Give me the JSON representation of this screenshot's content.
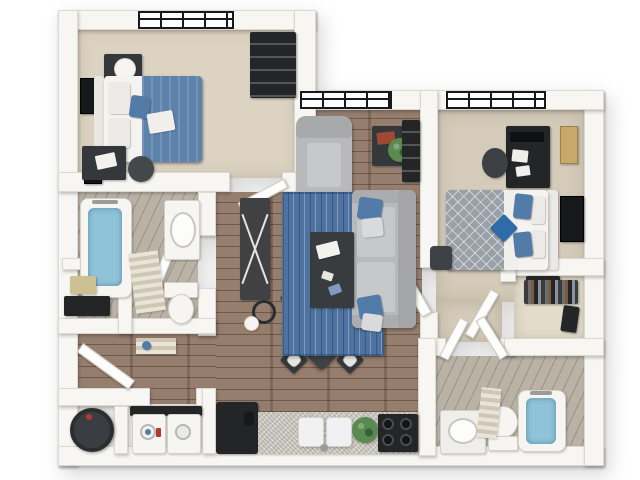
{
  "scene": {
    "title": "3D top-down floor plan of a two-bedroom, two-bathroom apartment",
    "view": "overhead 3D render, white outer background",
    "text_content": "none (image contains no visible text)"
  },
  "palette": {
    "wall": "#f7f6f2",
    "wedge": "#dcd9d2",
    "carpet": "#dcd3c2",
    "carpet2": "#d4cbba",
    "closetfloor": "#e3dccb",
    "wood": "#8b7260",
    "bathfloor": "#b5ac9f",
    "utilityfloor": "#e8e6e1",
    "rug": "#4e73a0",
    "sofa": "#b7b9bb",
    "cushion": "#c6c8ca",
    "dark": "#35383b",
    "darker": "#232527",
    "whiteobj": "#f6f5f2",
    "water": "#8fc3d8",
    "blue": "#527ba8",
    "denim": "#5d82ab",
    "graybed": "#9aa0a8",
    "granite": "#cbc8c0",
    "plantc": "#5a8a52",
    "tanc": "#cdc093",
    "art": "#17181a",
    "red": "#9c4a33",
    "doorleaf": "#fdfdfb"
  },
  "rooms": [
    {
      "name": "bedroom-1",
      "position": "top-left",
      "flooring": "carpet",
      "contents": [
        "window",
        "bed with white linens and denim-blue blanket",
        "blue accent pillow",
        "nightstand with lamp",
        "two wall art frames",
        "desk with laptop",
        "desk chair",
        "closet with dark shelving"
      ]
    },
    {
      "name": "bathroom-1",
      "position": "middle-left",
      "flooring": "gray wood plank",
      "contents": [
        "bathtub with water",
        "striped bath mat",
        "vanity with oval sink",
        "toilet",
        "linen niche with basket"
      ]
    },
    {
      "name": "entry",
      "position": "lower-left",
      "flooring": "wood plank",
      "contents": [
        "open entry door",
        "striped doormat",
        "blue watering can"
      ]
    },
    {
      "name": "utility-laundry",
      "position": "bottom-left",
      "flooring": "light",
      "contents": [
        "water heater",
        "washer",
        "dryer"
      ]
    },
    {
      "name": "kitchen",
      "position": "bottom-center",
      "flooring": "wood plank",
      "contents": [
        "refrigerator",
        "granite counter",
        "double-basin sink",
        "potted plant",
        "four-burner cooktop"
      ]
    },
    {
      "name": "dining-area",
      "position": "center-bottom",
      "flooring": "wood plank",
      "contents": [
        "square table rotated 45 degrees",
        "four chairs",
        "table decor"
      ]
    },
    {
      "name": "living-room",
      "position": "center",
      "flooring": "wood plank",
      "contents": [
        "window",
        "gray armchair",
        "side table with plant and red books",
        "ladder bookshelf",
        "blue area rug",
        "dark coffee table with books",
        "gray sofa with blue pillows",
        "tv console with x-legs",
        "floor lamp"
      ]
    },
    {
      "name": "bedroom-2",
      "position": "top-right",
      "flooring": "carpet",
      "contents": [
        "window",
        "desk with monitor and papers",
        "office chair",
        "corkboard",
        "bed with gray patterned duvet and blue pillows",
        "teal accent pillow",
        "wall art",
        "nightstand",
        "stool"
      ]
    },
    {
      "name": "walk-in-closet",
      "position": "right",
      "flooring": "carpet",
      "contents": [
        "hanging clothes",
        "storage box",
        "open door"
      ]
    },
    {
      "name": "bathroom-2",
      "position": "bottom-right",
      "flooring": "gray wood plank",
      "contents": [
        "double doors",
        "vanity with oval sink",
        "toilet",
        "bathtub with water",
        "striped towels"
      ]
    }
  ],
  "counts": {
    "bedrooms": 2,
    "bathrooms": 2,
    "windows": 3,
    "exterior_doors": 1
  }
}
